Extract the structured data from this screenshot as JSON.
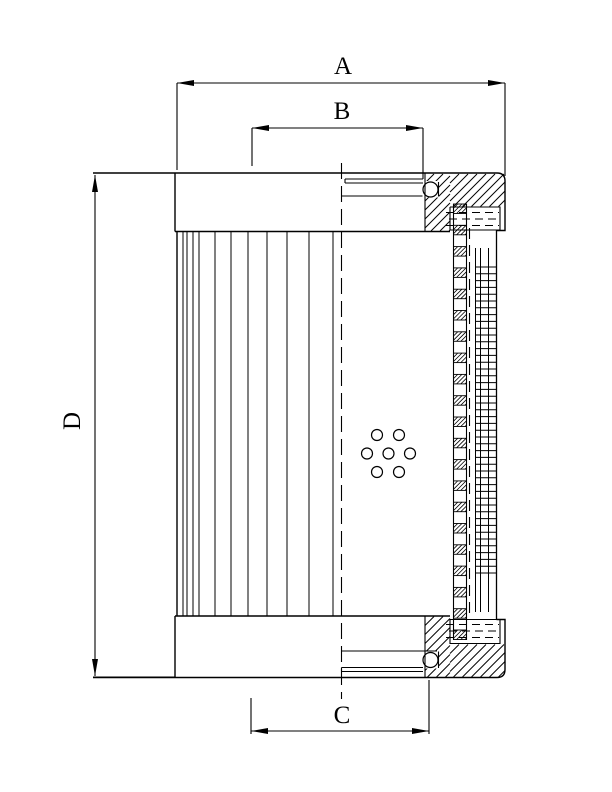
{
  "page": {
    "background_color": "#ffffff",
    "ink_color": "#000000",
    "description": "Black-and-white engineering cross-section drawing of a cylindrical filter element with pleated media, perforated core tube, support mesh, end caps with O-ring seals, and four dimension callouts"
  },
  "dimension_labels": {
    "a": "A",
    "b": "B",
    "c": "C",
    "d": "D"
  },
  "dimensions": [
    {
      "label": "A",
      "orientation": "horizontal",
      "position": "top-outer"
    },
    {
      "label": "B",
      "orientation": "horizontal",
      "position": "top-inner"
    },
    {
      "label": "C",
      "orientation": "horizontal",
      "position": "bottom"
    },
    {
      "label": "D",
      "orientation": "vertical",
      "position": "left"
    }
  ]
}
